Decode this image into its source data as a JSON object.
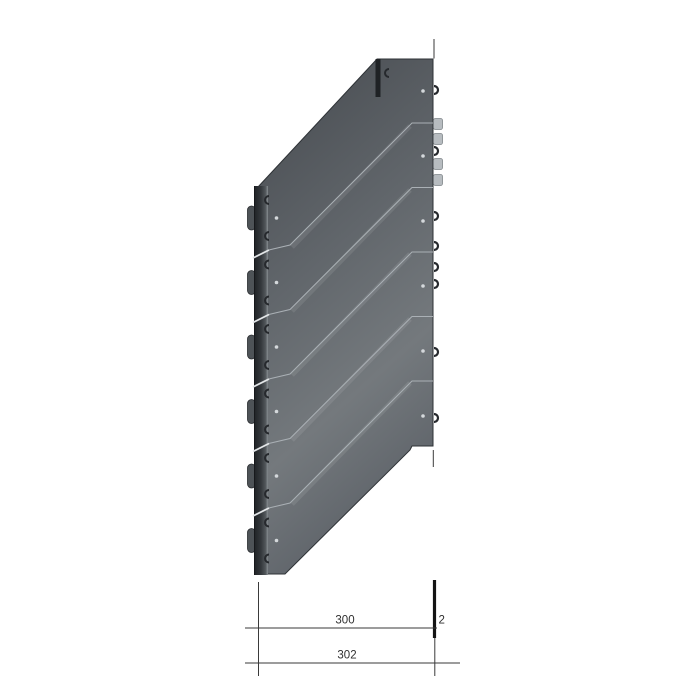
{
  "drawing": {
    "dimensions": {
      "inner_width": "300",
      "outer_width": "302",
      "edge_offset": "2"
    }
  },
  "colors": {
    "background": "#ffffff",
    "plate_top": "#45494e",
    "plate_mid": "#61666b",
    "plate_sheen": "#74797d",
    "plate_bottom": "#5f646a",
    "plate_edge": "#2e3236",
    "flange_dark": "#1f2225",
    "flange_mid": "#34383c",
    "flange_light": "#888e92",
    "bump_fill": "#4e5357",
    "separation_line": "#aab0b5",
    "gap_cut": "#e2e5e7",
    "clip_dark": "#26292d",
    "clip_light": "#b7bcc0",
    "hole": "#d4d8db",
    "dimension_line": "#3a3a3a",
    "dimension_text": "#2f2f2f",
    "thick_mark": "#141414"
  }
}
